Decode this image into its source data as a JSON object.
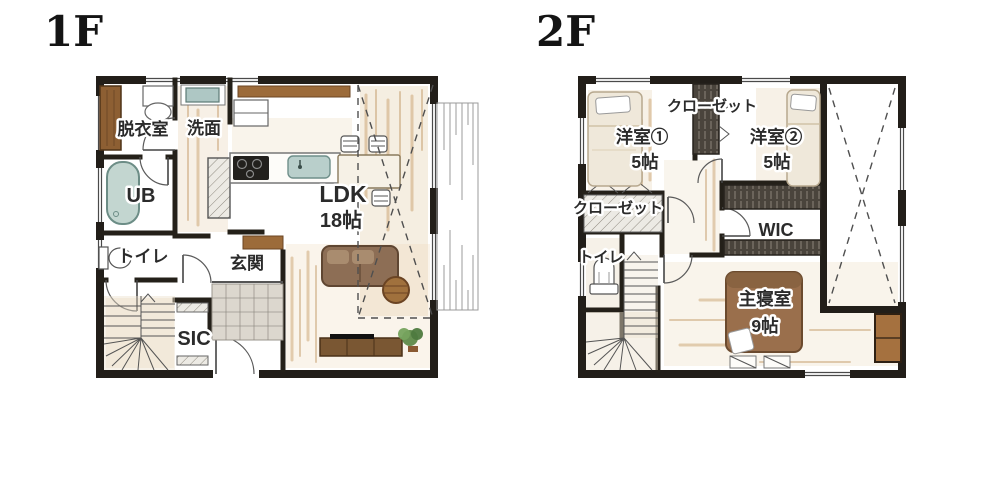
{
  "floors": [
    {
      "id": "1f",
      "title": "1F",
      "rooms": [
        {
          "key": "dressing-room",
          "label": "脱衣室"
        },
        {
          "key": "washroom",
          "label": "洗面"
        },
        {
          "key": "unit-bath",
          "label": "UB"
        },
        {
          "key": "toilet",
          "label": "トイレ"
        },
        {
          "key": "entrance",
          "label": "玄関"
        },
        {
          "key": "shoe-closet",
          "label": "SIC"
        },
        {
          "key": "living-dining-kitchen",
          "label": "LDK",
          "size": "18帖"
        }
      ]
    },
    {
      "id": "2f",
      "title": "2F",
      "rooms": [
        {
          "key": "closet-top",
          "label": "クローゼット"
        },
        {
          "key": "bedroom-1",
          "label": "洋室①",
          "size": "5帖"
        },
        {
          "key": "bedroom-2",
          "label": "洋室②",
          "size": "5帖"
        },
        {
          "key": "closet-side",
          "label": "クローゼット"
        },
        {
          "key": "toilet",
          "label": "トイレ"
        },
        {
          "key": "walk-in-closet",
          "label": "WIC"
        },
        {
          "key": "master-bedroom",
          "label": "主寝室",
          "size": "9帖"
        }
      ]
    }
  ],
  "colors": {
    "wall": "#221e19",
    "text": "#2b2b2b",
    "halo": "#ffffff",
    "wood_dark": "#7a5733",
    "wood_mid": "#9c6b3a",
    "wood_light": "#c69a63",
    "tub_fill": "#c3d6d0",
    "tub_stroke": "#6c8d86",
    "sink_fill": "#b9cfcb",
    "sofa": "#8d6e55",
    "bed_cream": "#efe8da",
    "bed_brown": "#9a6f4c",
    "closet_dark": "#4a443c",
    "tile": "#dcd7ce",
    "wash_tan": "#e0c9a4",
    "plant": "#5f8a4a",
    "dash": "#555555"
  }
}
